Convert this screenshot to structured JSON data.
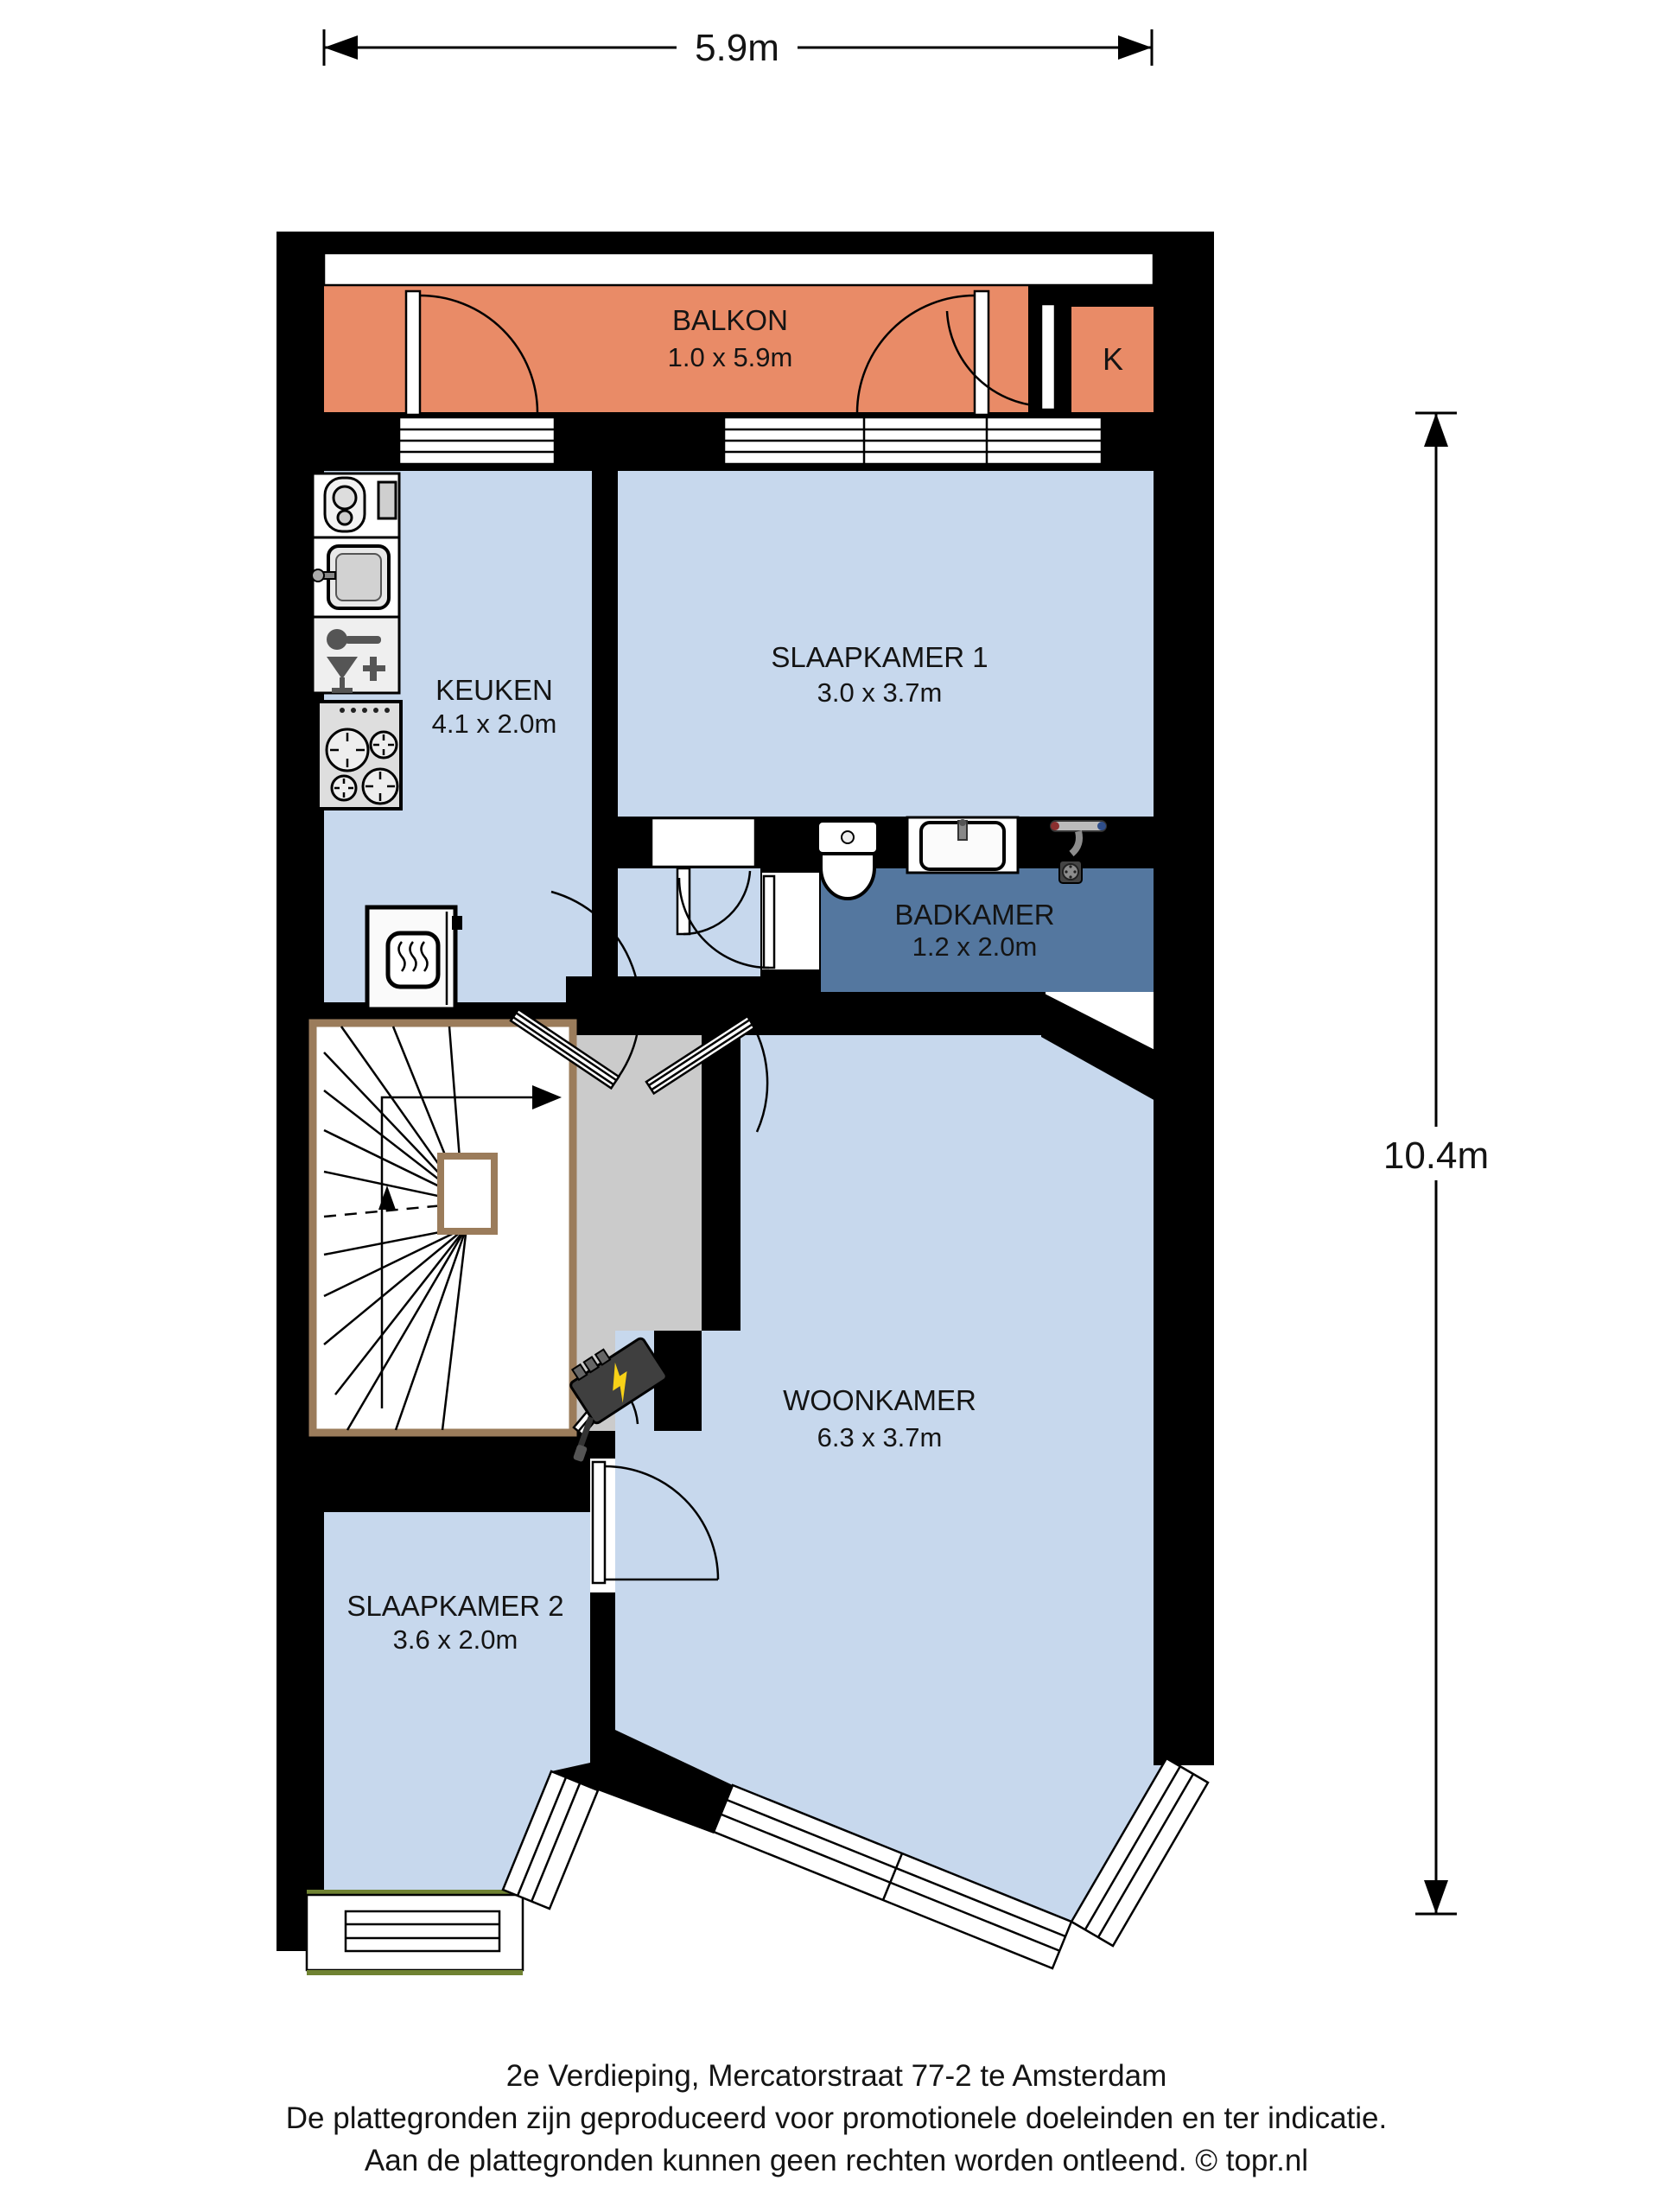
{
  "dimensions": {
    "width_label": "5.9m",
    "height_label": "10.4m"
  },
  "rooms": {
    "balkon": {
      "name": "BALKON",
      "size": "1.0 x 5.9m"
    },
    "closet": {
      "name": "K"
    },
    "keuken": {
      "name": "KEUKEN",
      "size": "4.1 x 2.0m"
    },
    "slaapkamer1": {
      "name": "SLAAPKAMER 1",
      "size": "3.0 x 3.7m"
    },
    "badkamer": {
      "name": "BADKAMER",
      "size": "1.2 x 2.0m"
    },
    "woonkamer": {
      "name": "WOONKAMER",
      "size": "6.3 x 3.7m"
    },
    "slaapkamer2": {
      "name": "SLAAPKAMER 2",
      "size": "3.6 x 2.0m"
    }
  },
  "footer": {
    "line1": "2e Verdieping, Mercatorstraat 77-2 te Amsterdam",
    "line2": "De plattegronden zijn geproduceerd voor promotionele doeleinden en ter indicatie.",
    "line3": "Aan de plattegronden kunnen geen rechten worden ontleend. © topr.nl"
  },
  "colors": {
    "wall": "#000000",
    "room": "#C7D8ED",
    "balcony": "#E98B67",
    "bathroom": "#54779F",
    "hall": "#CBCBCB",
    "stair_frame": "#9B7C5B",
    "accent_green": "#6F8232",
    "meter_bolt": "#F7D117"
  }
}
